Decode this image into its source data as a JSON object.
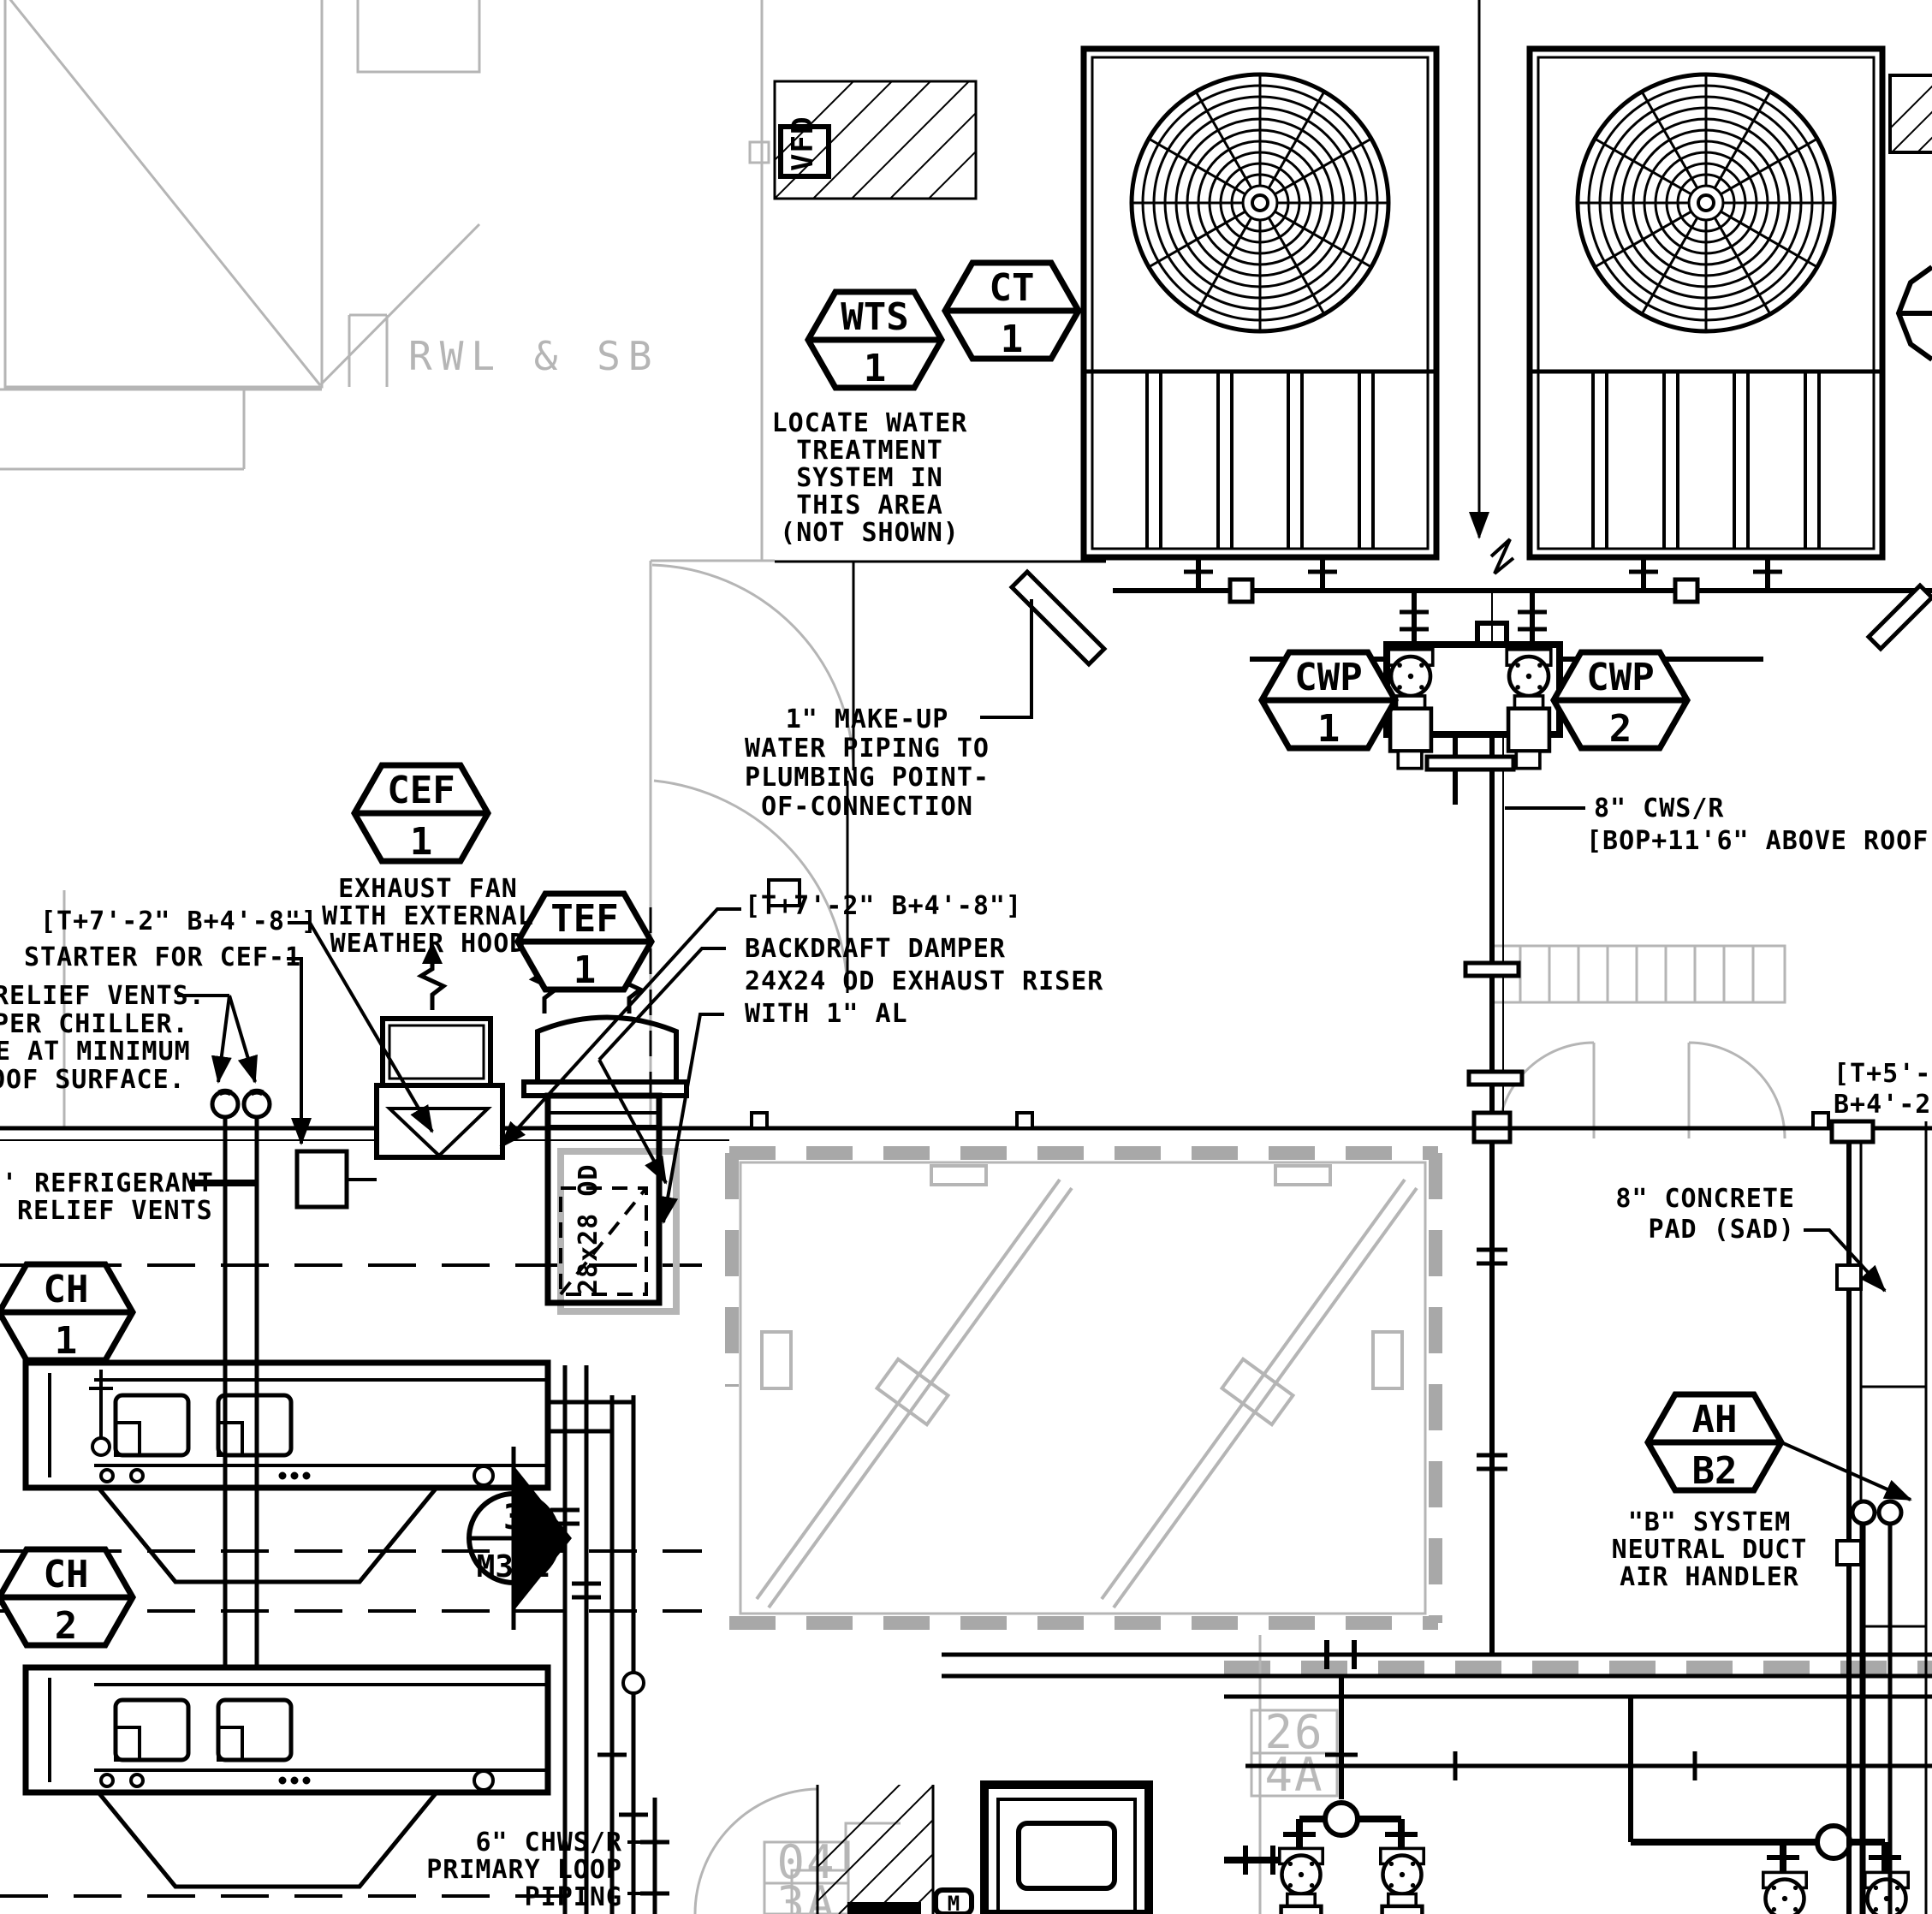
{
  "drawing": {
    "title_note": "mechanical roof plan",
    "colors": {
      "line": "#000000",
      "architectural_gray": "#b5b5b5",
      "background": "#ffffff"
    },
    "annotations": {
      "rwl_sb": "RWL & SB",
      "locate_water": [
        "LOCATE WATER",
        "TREATMENT",
        "SYSTEM IN",
        "THIS AREA",
        "(NOT SHOWN)"
      ],
      "makeup_water": [
        "1\" MAKE-UP",
        "WATER PIPING TO",
        "PLUMBING POINT-",
        "OF-CONNECTION"
      ],
      "cws_r": [
        "8\" CWS/R",
        "[BOP+11'6\" ABOVE ROOF]"
      ],
      "exhaust_fan": [
        "EXHAUST FAN",
        "WITH EXTERNAL",
        "WEATHER HOOD"
      ],
      "bracket_left": "[T+7'-2\" B+4'-8\"]",
      "starter": "STARTER FOR CEF-1",
      "relief_note": [
        "RELIEF VENTS.",
        "PER CHILLER.",
        "E AT MINIMUM",
        "OOF SURFACE."
      ],
      "refrigerant": [
        "' REFRIGERANT",
        "RELIEF VENTS"
      ],
      "bracket_center": "[T+7'-2\" B+4'-8\"]",
      "backdraft": [
        "BACKDRAFT DAMPER",
        "24X24 OD EXHAUST RISER",
        "WITH 1\" AL"
      ],
      "duct_size": "28x28 OD",
      "concrete_pad": [
        "8\" CONCRETE",
        "PAD (SAD)"
      ],
      "bracket_right": [
        "[T+5'-8",
        "B+4'-2'"
      ],
      "b_system": [
        "\"B\" SYSTEM",
        "NEUTRAL DUCT",
        "AIR HANDLER"
      ],
      "chws": [
        "6\" CHWS/R",
        "PRIMARY LOOP",
        "PIPING"
      ],
      "vfd": "VFD",
      "m_label": "M",
      "room_26": [
        "26",
        "4A"
      ],
      "room_04": [
        "04",
        "3A"
      ]
    },
    "tags": {
      "wts": {
        "top": "WTS",
        "bottom": "1"
      },
      "ct": {
        "top": "CT",
        "bottom": "1"
      },
      "cwp1": {
        "top": "CWP",
        "bottom": "1"
      },
      "cwp2": {
        "top": "CWP",
        "bottom": "2"
      },
      "cef": {
        "top": "CEF",
        "bottom": "1"
      },
      "tef": {
        "top": "TEF",
        "bottom": "1"
      },
      "ch1": {
        "top": "CH",
        "bottom": "1"
      },
      "ch2": {
        "top": "CH",
        "bottom": "2"
      },
      "ah": {
        "top": "AH",
        "bottom": "B2"
      },
      "section": {
        "top": "3",
        "bottom": "M302"
      }
    }
  }
}
